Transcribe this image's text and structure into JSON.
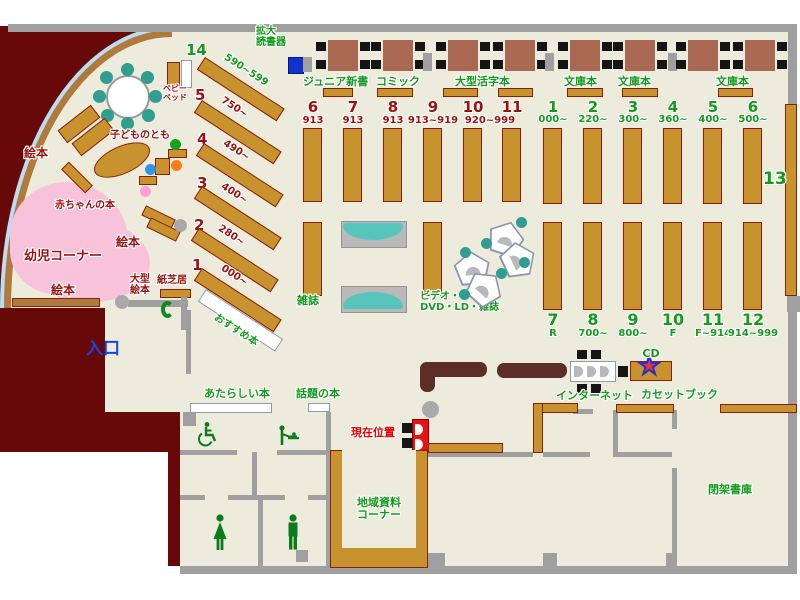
{
  "colors": {
    "floor": "#edebdc",
    "outside_maroon": "#670909",
    "shelf_brown": "#c8932f",
    "shelf_border": "#8a1f0f",
    "wall_gray": "#9f9f9f",
    "label_green": "#149a1e",
    "label_dark_red": "#9c1010",
    "entrance_blue": "#1742e8",
    "alert_red": "#e60000",
    "table_wood": "#a86852",
    "counter_brown": "#5d2d27",
    "teal": "#2f9e90",
    "kids_pink": "#f8c3da",
    "device_blue": "#1133cc",
    "arc_blue": "#b9ddf2"
  },
  "icons": {
    "cd_star": "★"
  },
  "areas": {
    "infant_corner": "幼児コーナー",
    "entrance": "入口",
    "current_position": "現在位置",
    "regional_line1": "地域資料",
    "regional_line2": "コーナー",
    "closed_stacks": "閉架書庫"
  },
  "kids": {
    "picture_books": "絵本",
    "baby_books": "赤ちゃんの本",
    "kids_mag": "子どものとも",
    "baby_bed_line1": "ベビー",
    "baby_bed_line2": "ベッド",
    "large_picture_line1": "大型",
    "large_picture_line2": "絵本",
    "kamishibai": "紙芝居"
  },
  "top": {
    "reader_line1": "拡大",
    "reader_line2": "読書器",
    "junior": "ジュニア新書",
    "comic": "コミック",
    "large_print": "大型活字本",
    "bunko": "文庫本"
  },
  "shelves": {
    "recommended": "おすすめ本",
    "magazines": "雑誌",
    "video_line1": "ビデオ・",
    "video_line2": "DVD・LD・雑誌",
    "new_books": "あたらしい本",
    "topic_books": "話題の本",
    "internet": "インターネット",
    "cd": "CD",
    "cassette": "カセットブック",
    "shelf13": "13"
  },
  "diag": [
    {
      "num": "14",
      "range": "590~599"
    },
    {
      "num": "5",
      "range": "750~"
    },
    {
      "num": "4",
      "range": "490~"
    },
    {
      "num": "3",
      "range": "400~"
    },
    {
      "num": "2",
      "range": "280~"
    },
    {
      "num": "1",
      "range": "000~"
    }
  ],
  "red_cols": [
    {
      "num": "6",
      "val": "913"
    },
    {
      "num": "7",
      "val": "913"
    },
    {
      "num": "8",
      "val": "913"
    },
    {
      "num": "9",
      "val": "913~919"
    },
    {
      "num": "10",
      "val": "920~999"
    },
    {
      "num": "11",
      "val": ""
    }
  ],
  "green_top": [
    {
      "num": "1",
      "val": "000~"
    },
    {
      "num": "2",
      "val": "220~"
    },
    {
      "num": "3",
      "val": "300~"
    },
    {
      "num": "4",
      "val": "360~"
    },
    {
      "num": "5",
      "val": "400~"
    },
    {
      "num": "6",
      "val": "500~"
    }
  ],
  "green_bottom": [
    {
      "num": "7",
      "val": "R"
    },
    {
      "num": "8",
      "val": "700~"
    },
    {
      "num": "9",
      "val": "800~"
    },
    {
      "num": "10",
      "val": "F"
    },
    {
      "num": "11",
      "val": "F~914"
    },
    {
      "num": "12",
      "val": "914~999"
    }
  ]
}
